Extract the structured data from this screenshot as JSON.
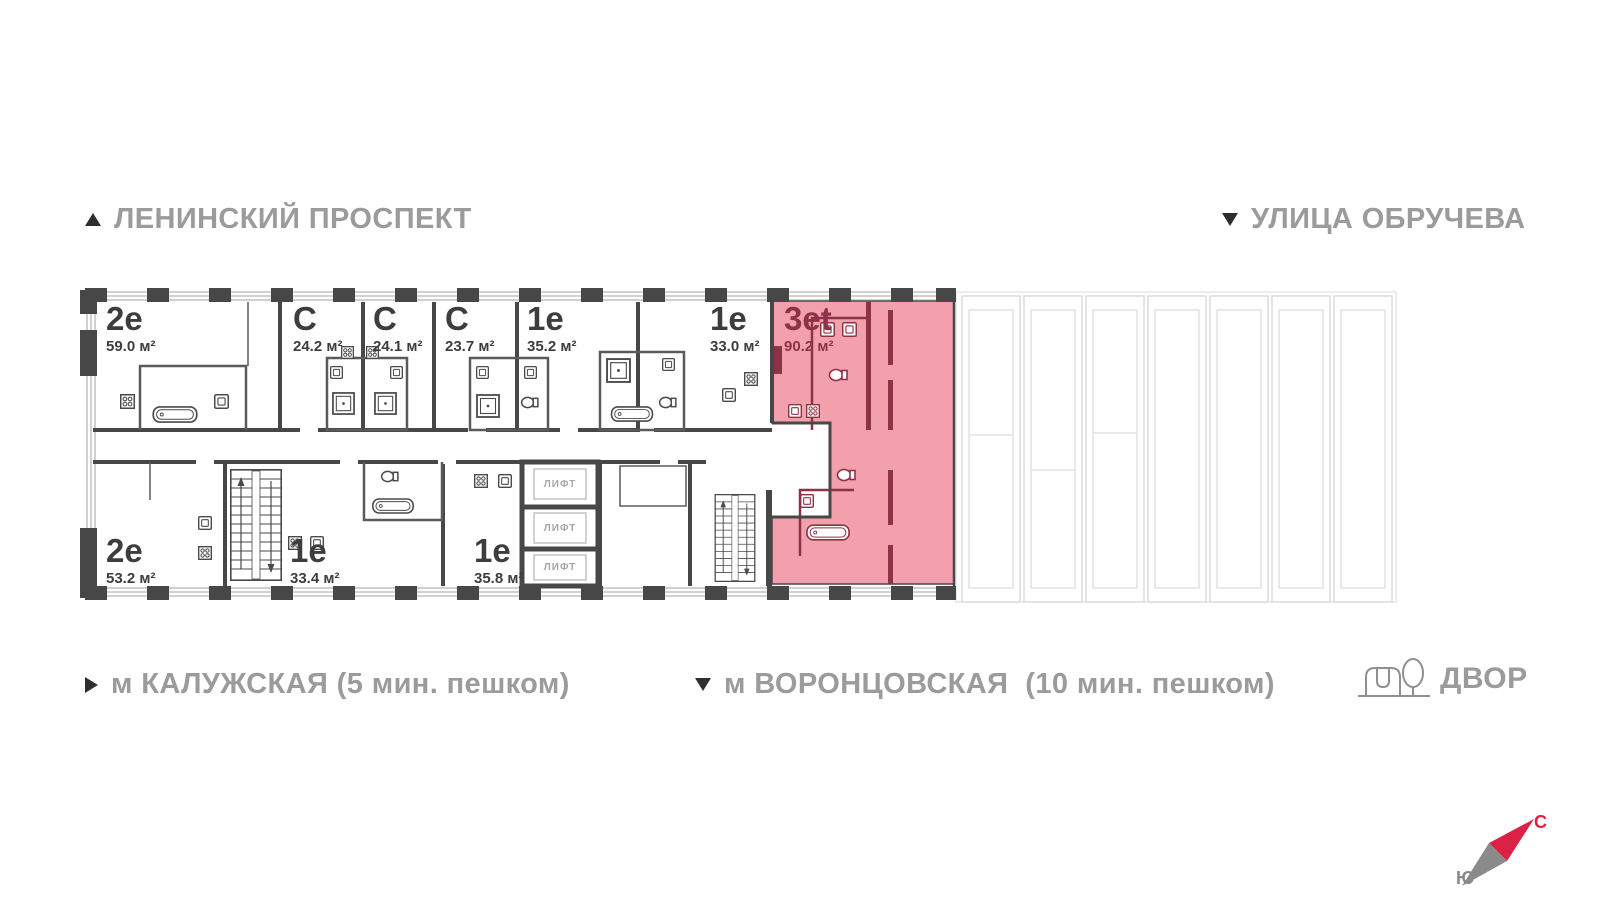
{
  "colors": {
    "highlight_fill": "#f1a0ac",
    "highlight_accent": "#8e3247",
    "wall": "#474747",
    "label_gray": "#9b9b9b",
    "unit_text": "#3d3d3d",
    "compass_north": "#dc2146",
    "faded_outline": "#dcdcdc"
  },
  "streets": {
    "top_left": {
      "text": "ЛЕНИНСКИЙ ПРОСПЕКТ",
      "direction": "up"
    },
    "top_right": {
      "text": "УЛИЦА ОБРУЧЕВА",
      "direction": "down"
    }
  },
  "metro": {
    "left": {
      "text": "м КАЛУЖСКАЯ (5 мин. пешком)",
      "direction": "right"
    },
    "center": {
      "text": "м ВОРОНЦОВСКАЯ  (10 мин. пешком)",
      "direction": "down"
    }
  },
  "yard": {
    "label": "ДВОР"
  },
  "compass": {
    "north": "С",
    "south": "Ю"
  },
  "plan": {
    "elevator_label": "ЛИФТ",
    "units": [
      {
        "type": "2е",
        "area": "59.0 м²",
        "row": "top",
        "highlighted": false
      },
      {
        "type": "С",
        "area": "24.2 м²",
        "row": "top",
        "highlighted": false
      },
      {
        "type": "С",
        "area": "24.1 м²",
        "row": "top",
        "highlighted": false
      },
      {
        "type": "С",
        "area": "23.7 м²",
        "row": "top",
        "highlighted": false
      },
      {
        "type": "1е",
        "area": "35.2 м²",
        "row": "top",
        "highlighted": false
      },
      {
        "type": "1е",
        "area": "33.0 м²",
        "row": "top",
        "highlighted": false
      },
      {
        "type": "3еt",
        "area": "90.2 м²",
        "row": "full",
        "highlighted": true
      },
      {
        "type": "2е",
        "area": "53.2 м²",
        "row": "bottom",
        "highlighted": false
      },
      {
        "type": "1е",
        "area": "33.4 м²",
        "row": "bottom",
        "highlighted": false
      },
      {
        "type": "1е",
        "area": "35.8 м²",
        "row": "bottom",
        "highlighted": false
      }
    ]
  }
}
